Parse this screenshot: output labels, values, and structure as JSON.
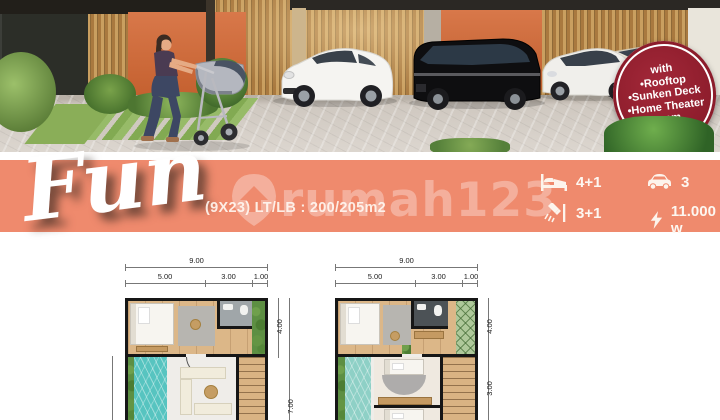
{
  "photo": {
    "badge": {
      "lines": [
        "with",
        "•Rooftop",
        "•Sunken Deck",
        "•Home Theater",
        "room"
      ],
      "bg_color": "#8C1C2B"
    }
  },
  "banner": {
    "title": "Fun",
    "spec": "(9X23) LT/LB : 200/205m2",
    "watermark": "rumah123",
    "accent_color": "#EF8A6D",
    "stats": [
      {
        "icon": "bed-icon",
        "value": "4+1"
      },
      {
        "icon": "car-icon",
        "value": "3"
      },
      {
        "icon": "shower-icon",
        "value": "3+1"
      },
      {
        "icon": "power-icon",
        "value": "11.000 w"
      }
    ]
  },
  "floorplans": [
    {
      "name": "floor-plan-1",
      "total_width": "9.00",
      "segments": [
        "5.00",
        "3.00",
        "1.00"
      ],
      "right_dims": [
        "4.00",
        "7.00"
      ]
    },
    {
      "name": "floor-plan-2",
      "total_width": "9.00",
      "segments": [
        "5.00",
        "3.00",
        "1.00"
      ],
      "right_dims": [
        "4.00",
        "3.00"
      ]
    }
  ],
  "colors": {
    "pool": "#57C4C0",
    "wood_floor": "#DCB788",
    "banner": "#EF8A6D",
    "badge": "#8C1C2B"
  }
}
